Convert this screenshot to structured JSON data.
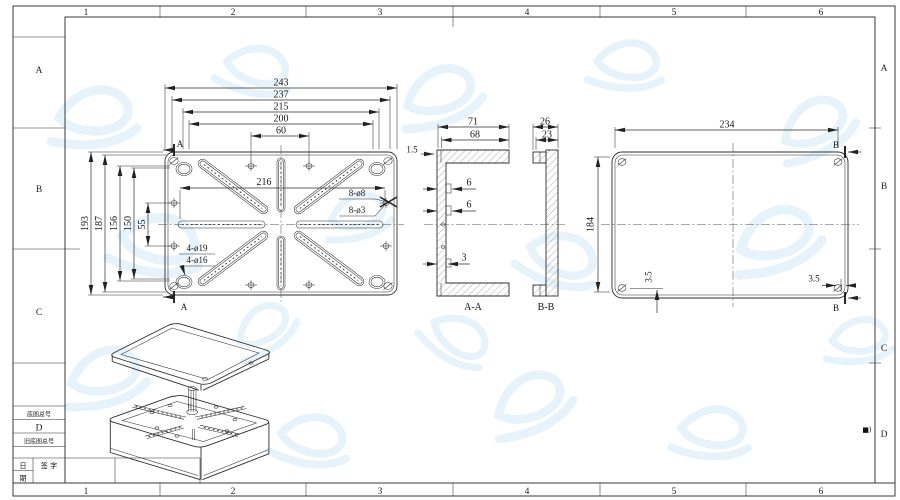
{
  "sheet": {
    "grid_columns": [
      "1",
      "2",
      "3",
      "4",
      "5",
      "6"
    ],
    "grid_rows": [
      "A",
      "B",
      "C",
      "D"
    ],
    "corner_mark": "■)",
    "title_block": {
      "base_drawing_no_label": "底图总号",
      "size_code": "D",
      "old_base_drawing_no_label": "旧底图总号",
      "date_label_line1": "日",
      "date_label_line2": "期",
      "signature_label": "签 字"
    },
    "colors": {
      "line": "#2e2e2e",
      "watermark": "#d8ecf8",
      "paper": "#ffffff"
    }
  },
  "views": {
    "plan": {
      "dim_width_outer": "243",
      "dim_width_inner": "237",
      "dim_width_3": "215",
      "dim_width_4": "200",
      "dim_hole_pitch_h": "60",
      "dim_rib_span": "216",
      "dim_height_outer": "193",
      "dim_height_inner": "187",
      "dim_height_3": "156",
      "dim_height_4": "150",
      "dim_hole_pitch_v": "55",
      "label_holes_large": "8-ø8",
      "label_holes_small": "8-ø3",
      "label_boss_outer": "4-ø19",
      "label_boss_inner": "4-ø16",
      "dim_lip": "1.5",
      "section_marker": "A"
    },
    "section_aa": {
      "title": "A-A",
      "dim_1": "71",
      "dim_2": "68",
      "dim_rib_top": "6",
      "dim_rib_mid": "6",
      "dim_rib_bottom": "3"
    },
    "section_bb": {
      "title": "B-B",
      "dim_1": "26",
      "dim_2": "23"
    },
    "back": {
      "dim_width": "234",
      "dim_height": "184",
      "dim_screw_left": "3.5",
      "dim_screw_right": "3.5",
      "section_marker": "B"
    }
  }
}
